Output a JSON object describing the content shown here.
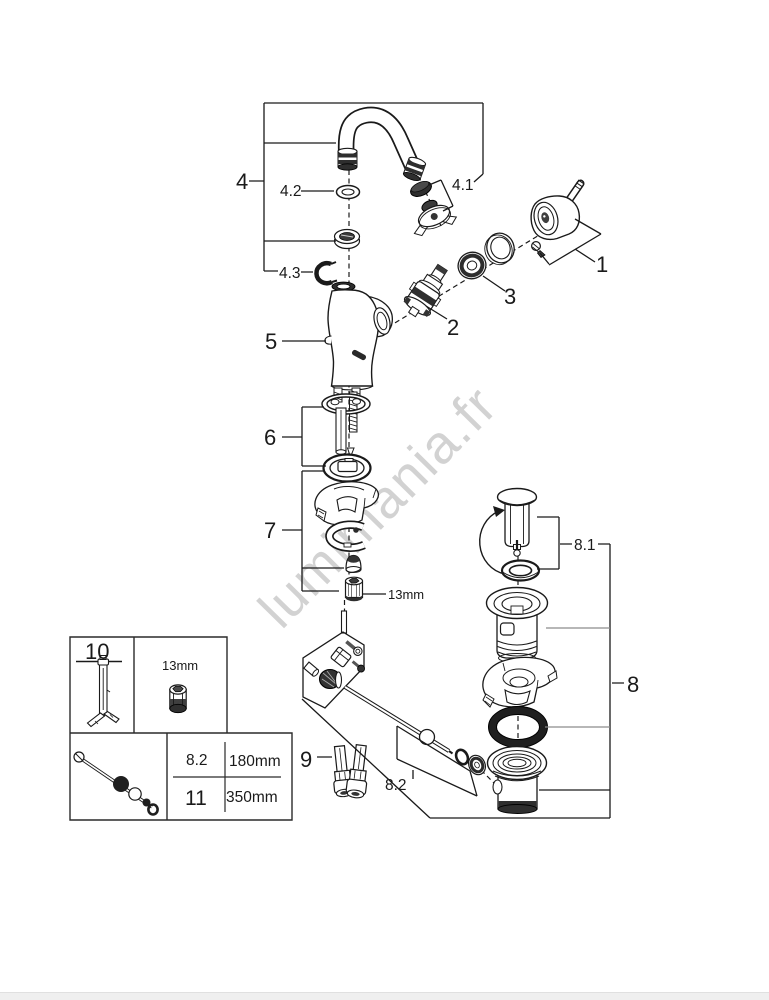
{
  "colors": {
    "background": "#ffffff",
    "line": "#1a1a1a",
    "dark_fill": "#2e2e2e",
    "watermark": "#d2d2d2"
  },
  "watermark": {
    "text": "lumimania.fr"
  },
  "callouts": {
    "c1": "1",
    "c2": "2",
    "c3": "3",
    "c4": "4",
    "c4_1": "4.1",
    "c4_2": "4.2",
    "c4_3": "4.3",
    "c5": "5",
    "c6": "6",
    "c7": "7",
    "c8": "8",
    "c8_1": "8.1",
    "c8_2": "8.2",
    "c9": "9",
    "nut_size": "13mm"
  },
  "info_box": {
    "tool_ref": "10",
    "socket_size": "13mm",
    "table": {
      "rows": [
        {
          "ref": "8.2",
          "length": "180mm"
        },
        {
          "ref": "11",
          "length": "350mm"
        }
      ]
    }
  }
}
